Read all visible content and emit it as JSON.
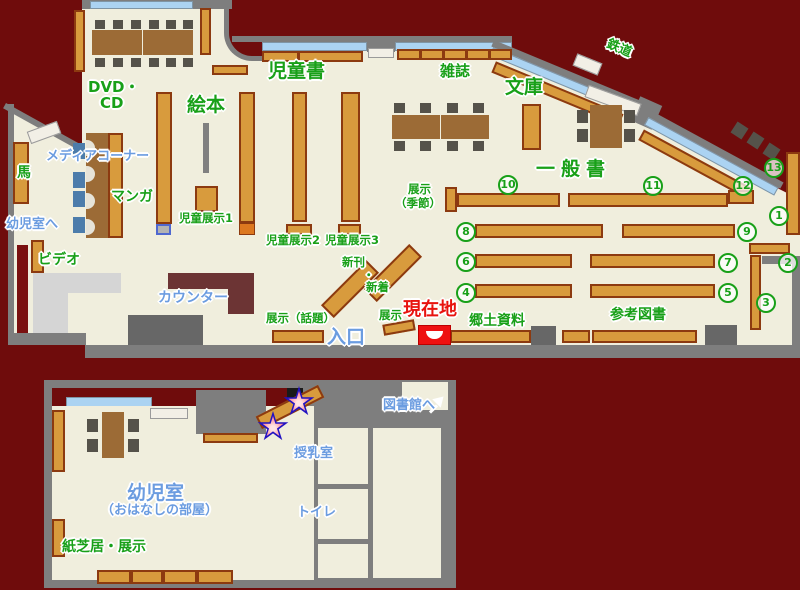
{
  "main_map": {
    "labels": {
      "dvd_line1": "DVD・",
      "dvd_line2": "CD",
      "media_corner": "メディアコーナー",
      "manga": "マンガ",
      "horse": "馬",
      "to_infant_room": "幼児室へ",
      "video": "ビデオ",
      "counter": "カウンター",
      "picture_books": "絵本",
      "childrens_books": "児童書",
      "child_display1": "児童展示1",
      "child_display2": "児童展示2",
      "child_display3": "児童展示3",
      "magazines": "雑誌",
      "paperbacks": "文庫",
      "railway": "鉄道",
      "general_books": "一般書",
      "display_seasonal_line1": "展示",
      "display_seasonal_line2": "（季節）",
      "new_arrivals_line1": "新刊",
      "new_arrivals_dot": "・",
      "new_arrivals_line2": "新着",
      "display_small": "展示",
      "display_topical": "展示（話題）",
      "entrance": "入口",
      "current_location": "現在地",
      "local_materials": "郷土資料",
      "reference_books": "参考図書"
    },
    "shelf_numbers": [
      "1",
      "2",
      "3",
      "4",
      "5",
      "6",
      "7",
      "8",
      "9",
      "10",
      "11",
      "12",
      "13"
    ],
    "colors": {
      "background": "#6f0c0c",
      "floor": "#f0eedd",
      "wall": "#7e7e7e",
      "shelf": "#d89b3d",
      "window": "#abd3f2",
      "label_green": "#18a018",
      "label_blue": "#6b9ce0",
      "current_location_red": "#e8130f"
    }
  },
  "annex_map": {
    "labels": {
      "to_library": "図書館へ",
      "nursing_room": "授乳室",
      "toilet": "トイレ",
      "infant_room": "幼児室",
      "infant_room_sub": "（おはなしの部屋）",
      "kamishibai_display": "紙芝居・展示"
    }
  }
}
